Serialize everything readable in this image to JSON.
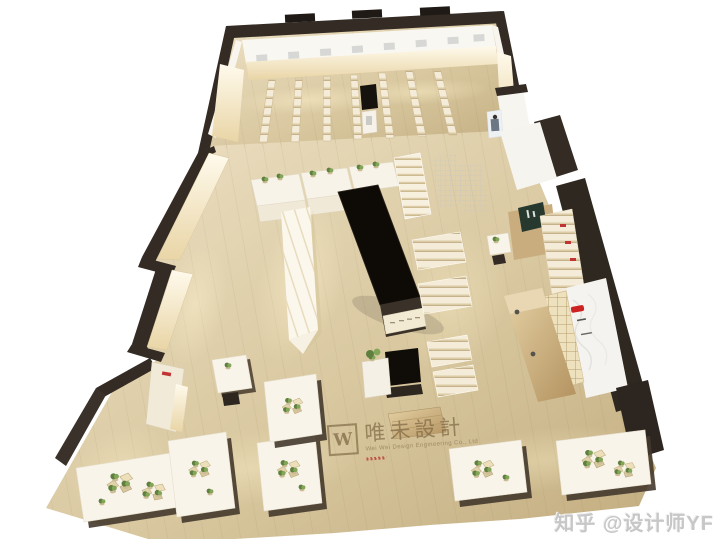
{
  "watermark": {
    "logo_letter": "W",
    "brand_cn": "唯未設計",
    "brand_en": "Wei Wei Design Engineering Co., Ltd"
  },
  "credit": {
    "text": "知乎 @设计师YF"
  },
  "palette": {
    "background": "#ffffff",
    "floor_light": "#eee2c6",
    "floor_dark": "#c3ad80",
    "wall_dark": "#332b24",
    "counter_black": "#0e0b07",
    "shelf_cream": "#f4ecd8",
    "glow_warm": "#fff3cd",
    "plant_green": "#6b8c4a",
    "sign_green": "#27392e",
    "logo_red": "#cc2222",
    "watermark_brown": "#76603c",
    "credit_gray": "#c7c7c7"
  }
}
